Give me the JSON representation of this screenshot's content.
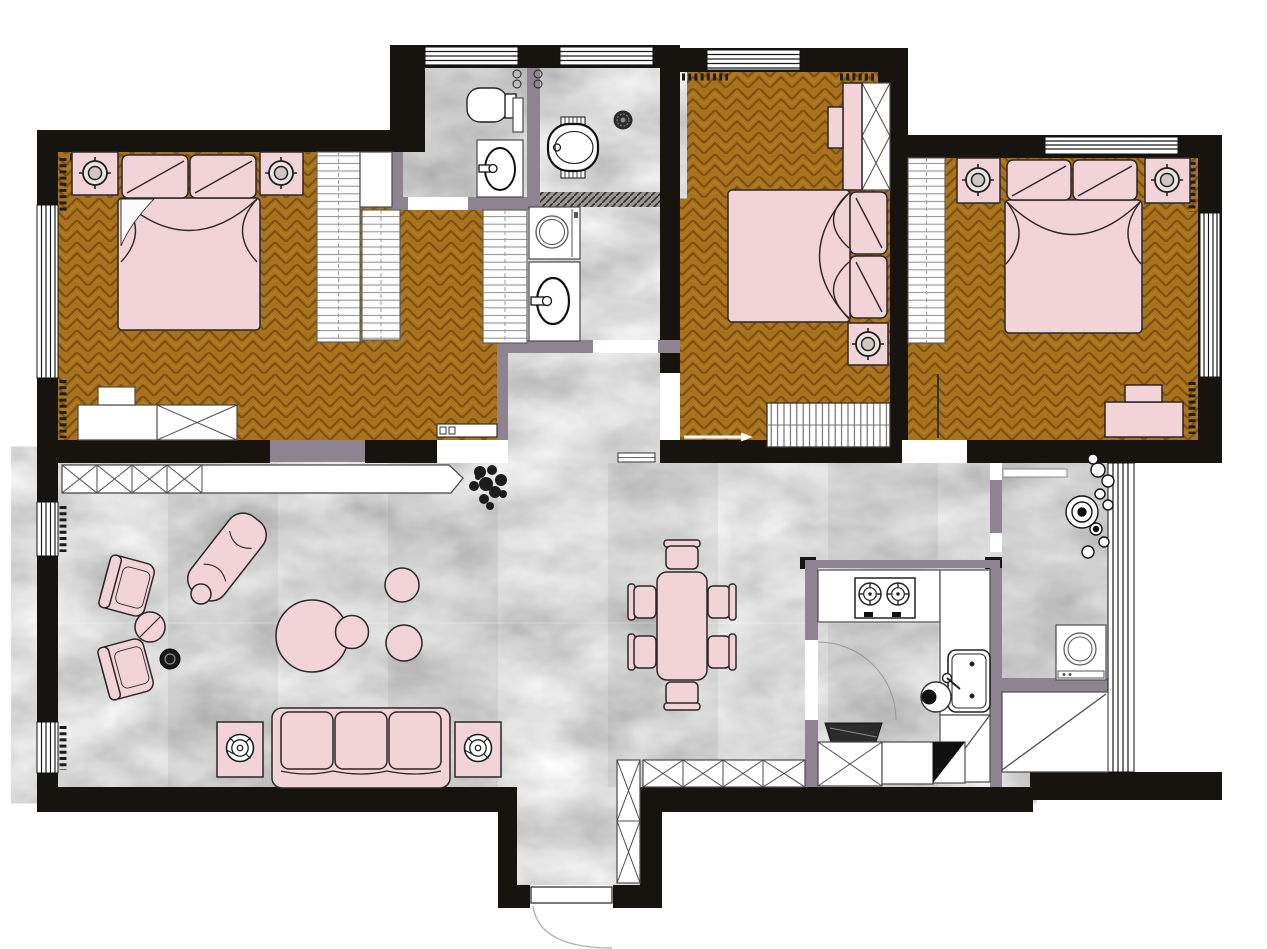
{
  "document": {
    "kind": "apartment-floor-plan",
    "view": "top-down color rendering",
    "visible_text": [],
    "floor_finishes": [
      "herringbone-wood",
      "gray-marble-tile",
      "white-cabinetry"
    ]
  },
  "palette": {
    "background": "#ffffff",
    "wall": "#17130f",
    "partition": "#8d8391",
    "wood-base": "#a9721c",
    "wood-dark": "#7d5110",
    "wood-light": "#bd8426",
    "marble-base": "#b5b3b1",
    "pink": "#f2d4d8",
    "pink-outline": "#2b2629",
    "fixture": "#ffffff",
    "fixture-outline": "#222222",
    "plant": "#1c1c1c",
    "hatch": "#9a9896"
  },
  "rooms": [
    {
      "name": "master-bedroom",
      "floor": "herringbone-wood",
      "items": [
        "double-bed",
        "pillows",
        "nightstand-left",
        "nightstand-right",
        "ceiling-light-left",
        "ceiling-light-right",
        "dresser",
        "window-left",
        "curtains"
      ]
    },
    {
      "name": "walk-in-closet",
      "floor": "herringbone-wood",
      "items": [
        "wardrobe-rack-a",
        "wardrobe-rack-b",
        "wardrobe-rack-c",
        "shelf-box",
        "sliding-door"
      ]
    },
    {
      "name": "wc",
      "floor": "marble",
      "items": [
        "toilet",
        "washbasin",
        "paper-holder",
        "wall-shelf",
        "door-opening"
      ]
    },
    {
      "name": "shower-room",
      "floor": "marble",
      "items": [
        "bathtub",
        "floor-drain",
        "paper-holder",
        "mosaic-threshold"
      ]
    },
    {
      "name": "laundry-nook",
      "floor": "marble",
      "items": [
        "washing-machine",
        "washbasin",
        "door-opening"
      ]
    },
    {
      "name": "bedroom-2",
      "floor": "herringbone-wood",
      "items": [
        "double-bed",
        "pillows",
        "nightstand",
        "ceiling-light",
        "wardrobe-x",
        "headboard-panel",
        "radiator",
        "door-opening",
        "window-top",
        "curtains"
      ]
    },
    {
      "name": "bedroom-3",
      "floor": "herringbone-wood",
      "items": [
        "double-bed",
        "pillows",
        "nightstand-left",
        "nightstand-right",
        "ceiling-light-left",
        "ceiling-light-right",
        "wardrobe-rack",
        "desk",
        "desk-shelf",
        "door-opening",
        "window-top",
        "window-right",
        "curtains"
      ]
    },
    {
      "name": "living-room",
      "floor": "marble",
      "items": [
        "tv-console",
        "plant",
        "armchair-1",
        "armchair-2",
        "side-round-table",
        "black-stool",
        "chaise-lounge",
        "small-round-table",
        "coffee-table-large",
        "coffee-table-small",
        "pouf-1",
        "pouf-2",
        "sofa-3-seat",
        "lamp-table-left",
        "lamp-table-right",
        "windows-left",
        "curtains"
      ]
    },
    {
      "name": "dining-area",
      "floor": "marble",
      "items": [
        "dining-table",
        "dining-chairs-x6",
        "wall-niche",
        "cabinet-row"
      ]
    },
    {
      "name": "kitchen",
      "floor": "marble",
      "items": [
        "counter-top",
        "counter-right",
        "cooktop-2-burner",
        "sink",
        "stool",
        "range-hood",
        "x-cabinet",
        "base-cabinet",
        "fridge-corner",
        "corner-cabinet",
        "door-arc"
      ]
    },
    {
      "name": "balcony",
      "floor": "marble",
      "items": [
        "plант-cluster",
        "sliding-door-bar",
        "washing-machine",
        "storage-cabinet-diagonal",
        "window-right"
      ]
    },
    {
      "name": "entry-vestibule",
      "floor": "marble",
      "items": [
        "shoe-cabinet",
        "entrance-door",
        "door-swing-arc"
      ]
    }
  ]
}
